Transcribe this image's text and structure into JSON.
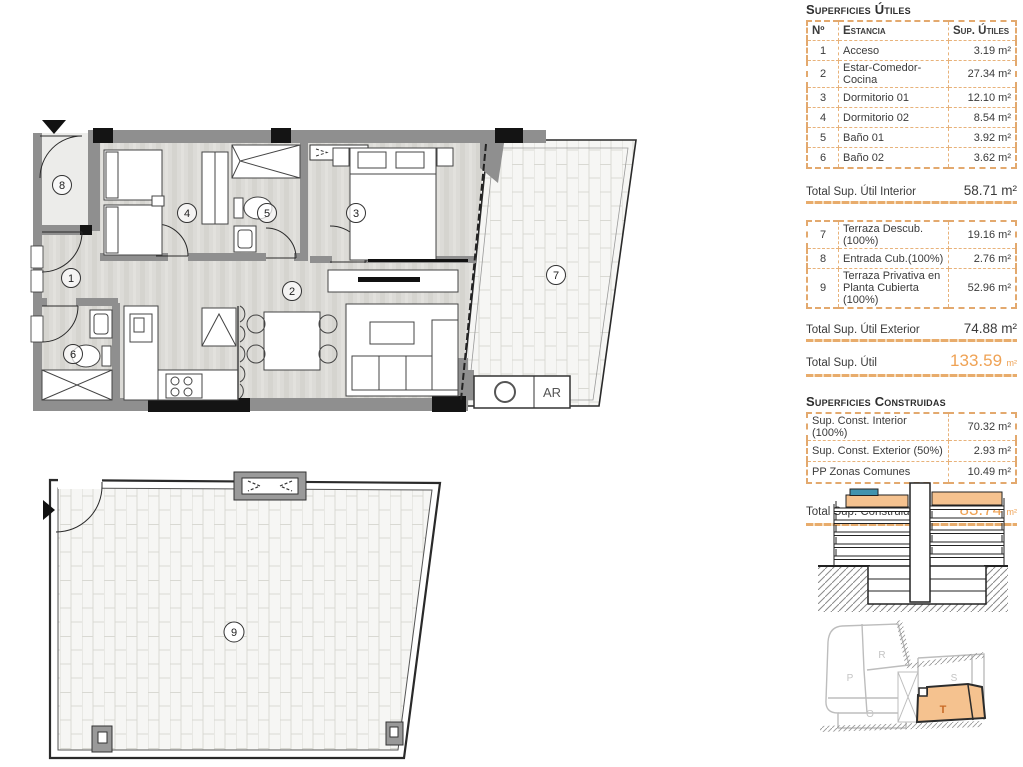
{
  "colors": {
    "accent_orange": "#EFA254",
    "table_border": "#E3A96E",
    "highlight_fill": "#F5C28F",
    "roof_blue": "#4193AE",
    "unit_letter_orange": "#C96A26"
  },
  "panel": {
    "useful": {
      "title": "Superficies Útiles",
      "columns": {
        "num": "Nº",
        "room": "Estancia",
        "area": "Sup. Útiles"
      },
      "rows": [
        {
          "num": "1",
          "room": "Acceso",
          "area": "3.19 m²"
        },
        {
          "num": "2",
          "room": "Estar-Comedor-Cocina",
          "area": "27.34 m²"
        },
        {
          "num": "3",
          "room": "Dormitorio 01",
          "area": "12.10 m²"
        },
        {
          "num": "4",
          "room": "Dormitorio 02",
          "area": "8.54 m²"
        },
        {
          "num": "5",
          "room": "Baño 01",
          "area": "3.92 m²"
        },
        {
          "num": "6",
          "room": "Baño 02",
          "area": "3.62 m²"
        }
      ],
      "total_interior": {
        "label": "Total Sup. Útil Interior",
        "value": "58.71 m²"
      },
      "exterior_rows": [
        {
          "num": "7",
          "room": "Terraza Descub.(100%)",
          "area": "19.16 m²"
        },
        {
          "num": "8",
          "room": "Entrada Cub.(100%)",
          "area": "2.76 m²"
        },
        {
          "num": "9",
          "room": "Terraza Privativa en Planta Cubierta (100%)",
          "area": "52.96 m²"
        }
      ],
      "total_exterior": {
        "label": "Total Sup. Útil Exterior",
        "value": "74.88 m²"
      },
      "total": {
        "label": "Total Sup. Útil",
        "value": "133.59",
        "unit": "m²"
      }
    },
    "built": {
      "title": "Superficies Construidas",
      "rows": [
        {
          "label": "Sup. Const. Interior (100%)",
          "value": "70.32 m²"
        },
        {
          "label": "Sup. Const. Exterior (50%)",
          "value": "2.93 m²"
        },
        {
          "label": "PP Zonas Comunes",
          "value": "10.49 m²"
        }
      ],
      "total": {
        "label": "Total Sup. Construida",
        "value": "83.74",
        "unit": "m²"
      }
    }
  },
  "plan": {
    "labels": {
      "r1": "1",
      "r2": "2",
      "r3": "3",
      "r4": "4",
      "r5": "5",
      "r6": "6",
      "r7": "7",
      "r8": "8",
      "r9": "9"
    },
    "ar_label": "AR"
  },
  "siteplan": {
    "r": "R",
    "p": "P",
    "s": "S",
    "o": "O",
    "t": "T"
  }
}
